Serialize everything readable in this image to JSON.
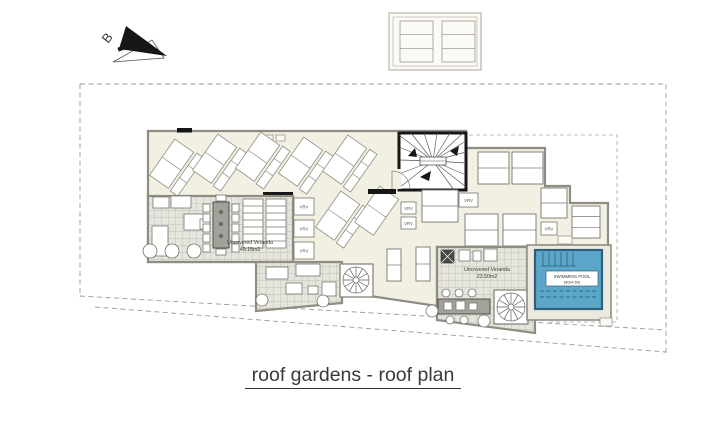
{
  "drawing": {
    "title": "roof gardens - roof plan",
    "section_marker": "B",
    "veranda_left": {
      "name": "Uncovered Veranda",
      "area": "49.15m2"
    },
    "veranda_right": {
      "name": "Uncovered Veranda",
      "area": "23.50m2"
    },
    "pool": {
      "name": "SWIMMING POOL",
      "size": "(40x4.60)"
    },
    "vrv_label": "VRV",
    "colors": {
      "roof": "#f2efe3",
      "veranda": "#e5e5de",
      "pool": "#5ba6c9",
      "wall": "#161616",
      "parapet": "#8f8d82",
      "boundary": "#9a9a9a"
    }
  }
}
